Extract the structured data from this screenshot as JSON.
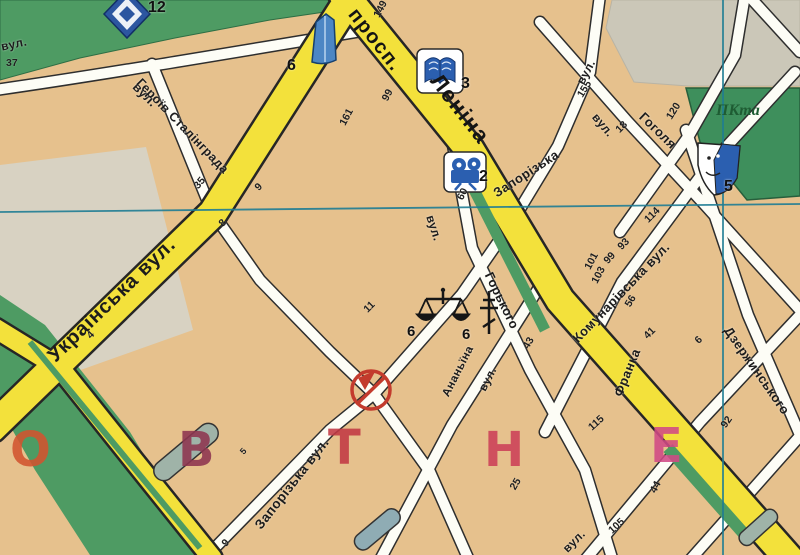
{
  "map": {
    "avenue": {
      "prefix": "просп.",
      "name": "Леніна"
    },
    "street_labels": [
      {
        "text": "просп."
      },
      {
        "text": "Леніна"
      },
      {
        "text": "Українська вул."
      },
      {
        "text": "вул."
      },
      {
        "text": "Героїв Сталінграда"
      },
      {
        "text": "вул."
      },
      {
        "text": "Запорізька"
      },
      {
        "text": "вул."
      },
      {
        "text": "Запорізька вул."
      },
      {
        "text": "вул."
      },
      {
        "text": "вул."
      },
      {
        "text": "Гоголя"
      },
      {
        "text": "Горького"
      },
      {
        "text": "Комунарівська вул."
      },
      {
        "text": "Франка"
      },
      {
        "text": "Дзержинського"
      },
      {
        "text": "Ананьїна"
      },
      {
        "text": "вул."
      },
      {
        "text": "вул."
      }
    ],
    "park_label": "ПКта",
    "house_numbers": [
      {
        "text": "37"
      },
      {
        "text": "149"
      },
      {
        "text": "99"
      },
      {
        "text": "161"
      },
      {
        "text": "35"
      },
      {
        "text": "9"
      },
      {
        "text": "8"
      },
      {
        "text": "4"
      },
      {
        "text": "11"
      },
      {
        "text": "60"
      },
      {
        "text": "155"
      },
      {
        "text": "18"
      },
      {
        "text": "120"
      },
      {
        "text": "114"
      },
      {
        "text": "93"
      },
      {
        "text": "99"
      },
      {
        "text": "101"
      },
      {
        "text": "103"
      },
      {
        "text": "56"
      },
      {
        "text": "41"
      },
      {
        "text": "43"
      },
      {
        "text": "6"
      },
      {
        "text": "92"
      },
      {
        "text": "115"
      },
      {
        "text": "25"
      },
      {
        "text": "105"
      },
      {
        "text": "44"
      },
      {
        "text": "5"
      },
      {
        "text": "9"
      }
    ],
    "poi": [
      {
        "icon": "sports-complex",
        "number": "12"
      },
      {
        "icon": "tower-building",
        "number": "6"
      },
      {
        "icon": "library-book",
        "number": "3"
      },
      {
        "icon": "cinema-camera",
        "number": "2"
      },
      {
        "icon": "court-scales",
        "number": "6"
      },
      {
        "icon": "church-cross",
        "number": "6"
      },
      {
        "icon": "theatre-mask",
        "number": "5"
      },
      {
        "icon": "closed-monument",
        "number": ""
      }
    ],
    "district_letters": [
      {
        "ch": "О",
        "color": "#D2542F"
      },
      {
        "ch": "В",
        "color": "#8E3550"
      },
      {
        "ch": "Т",
        "color": "#C23944"
      },
      {
        "ch": "Н",
        "color": "#CC4058"
      },
      {
        "ch": "Е",
        "color": "#D14A86"
      }
    ],
    "colors": {
      "block": "#E6C18D",
      "major_road": "#F3E13B",
      "minor_road": "#FDFDF6",
      "park": "#4E9B63",
      "unmapped_gray": "#CBC7B8",
      "grid_line": "#1F7D94",
      "poi_blue": "#2B5FB0",
      "prohibit_red": "#C33B2D"
    }
  }
}
